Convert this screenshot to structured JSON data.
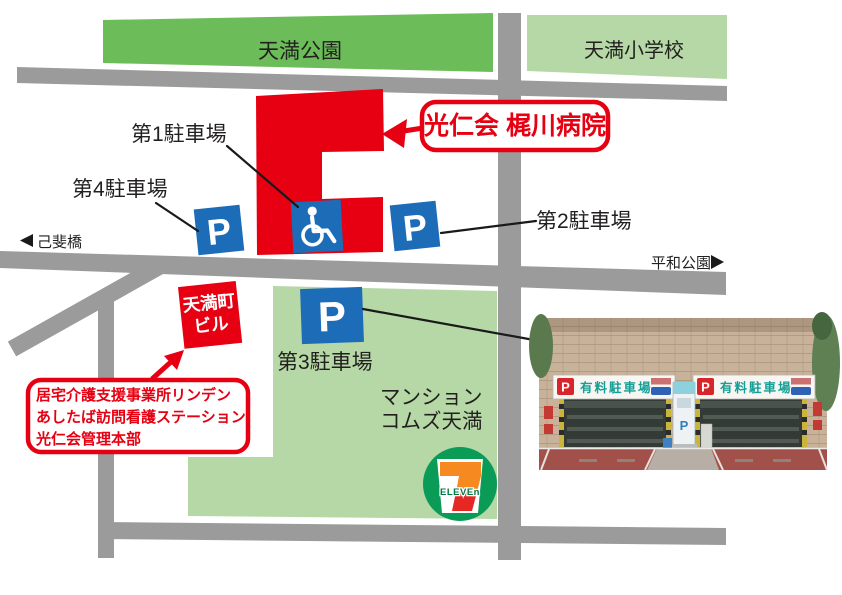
{
  "places": {
    "park": "天満公園",
    "school": "天満小学校",
    "mansion_line1": "マンション",
    "mansion_line2": "コムズ天満",
    "tenmacho_bldg_line1": "天満町",
    "tenmacho_bldg_line2": "ビル"
  },
  "hospital": {
    "label": "光仁会 梶川病院"
  },
  "office_box": {
    "line1": "居宅介護支援事業所リンデン",
    "line2": "あしたば訪問看護ステーション",
    "line3": "光仁会管理本部"
  },
  "parking": {
    "p1": "第1駐車場",
    "p2": "第2駐車場",
    "p3": "第3駐車場",
    "p4": "第4駐車場",
    "p_letter": "P"
  },
  "directions": {
    "west_arrow": "◀",
    "west_label": "己斐橋",
    "east_label": "平和公園",
    "east_arrow": "▶"
  },
  "seven_eleven": {
    "seven": "7",
    "eleven": "ELEVEn"
  },
  "photo_overlay": {
    "sign_p": "P",
    "sign_text": "有料駐車場",
    "kiosk_letter": "P"
  },
  "colors": {
    "map_red": "#e60012",
    "parking_blue": "#1d6cb8",
    "park_green": "#6cbc59",
    "light_green": "#b5d8a6",
    "road_gray": "#9b9b9b",
    "seven_green": "#0a9b57",
    "seven_orange": "#f6891f",
    "seven_red": "#e52823",
    "sign_teal": "#14a097"
  }
}
